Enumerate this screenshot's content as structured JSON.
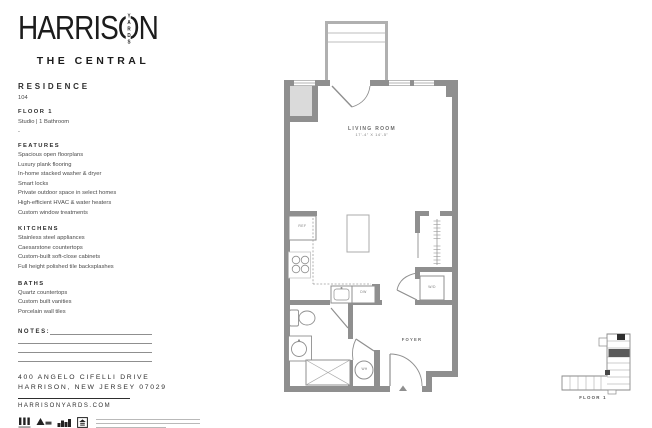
{
  "brand": {
    "logo_part1": "HARRIS",
    "logo_o_char": "O",
    "logo_o_letters": "YARDS",
    "logo_part2": "N",
    "subtitle": "THE CENTRAL"
  },
  "residence": {
    "heading": "RESIDENCE",
    "number": "104",
    "floor": "FLOOR 1",
    "type": "Studio | 1 Bathroom",
    "separator": "-"
  },
  "sections": {
    "features": {
      "heading": "FEATURES",
      "items": [
        "Spacious open floorplans",
        "Luxury plank flooring",
        "In-home stacked washer & dryer",
        "Smart locks",
        "Private outdoor space in select homes",
        "High-efficient HVAC & water heaters",
        "Custom window treatments"
      ]
    },
    "kitchens": {
      "heading": "KITCHENS",
      "items": [
        "Stainless steel appliances",
        "Caesarstone countertops",
        "Custom-built soft-close cabinets",
        "Full height polished tile backsplashes"
      ]
    },
    "baths": {
      "heading": "BATHS",
      "items": [
        "Quartz countertops",
        "Custom built vanities",
        "Porcelain wall tiles"
      ]
    }
  },
  "notes": {
    "heading": "NOTES:"
  },
  "contact": {
    "address_line1": "400 ANGELO CIFELLI DRIVE",
    "address_line2": "HARRISON, NEW JERSEY 07029",
    "website": "HARRISONYARDS.COM"
  },
  "floorplan": {
    "living_room_label": "LIVING ROOM",
    "living_room_dims": "17'-4\" X 14'-5\"",
    "foyer_label": "FOYER",
    "ref_label": "REF",
    "dw_label": "DW",
    "wd_label": "W/D",
    "wh_label": "WH"
  },
  "keyplan": {
    "label": "FLOOR 1"
  },
  "icons": [
    "harrison-yards-mark",
    "avis-logo",
    "city-skyline-logo",
    "equal-housing-logo"
  ],
  "colors": {
    "wall": "#8f8f8f",
    "wall_light": "#b0b0b0",
    "shaft_fill": "#dadada",
    "text": "#3d3d3d",
    "logo": "#1c1c1c"
  }
}
